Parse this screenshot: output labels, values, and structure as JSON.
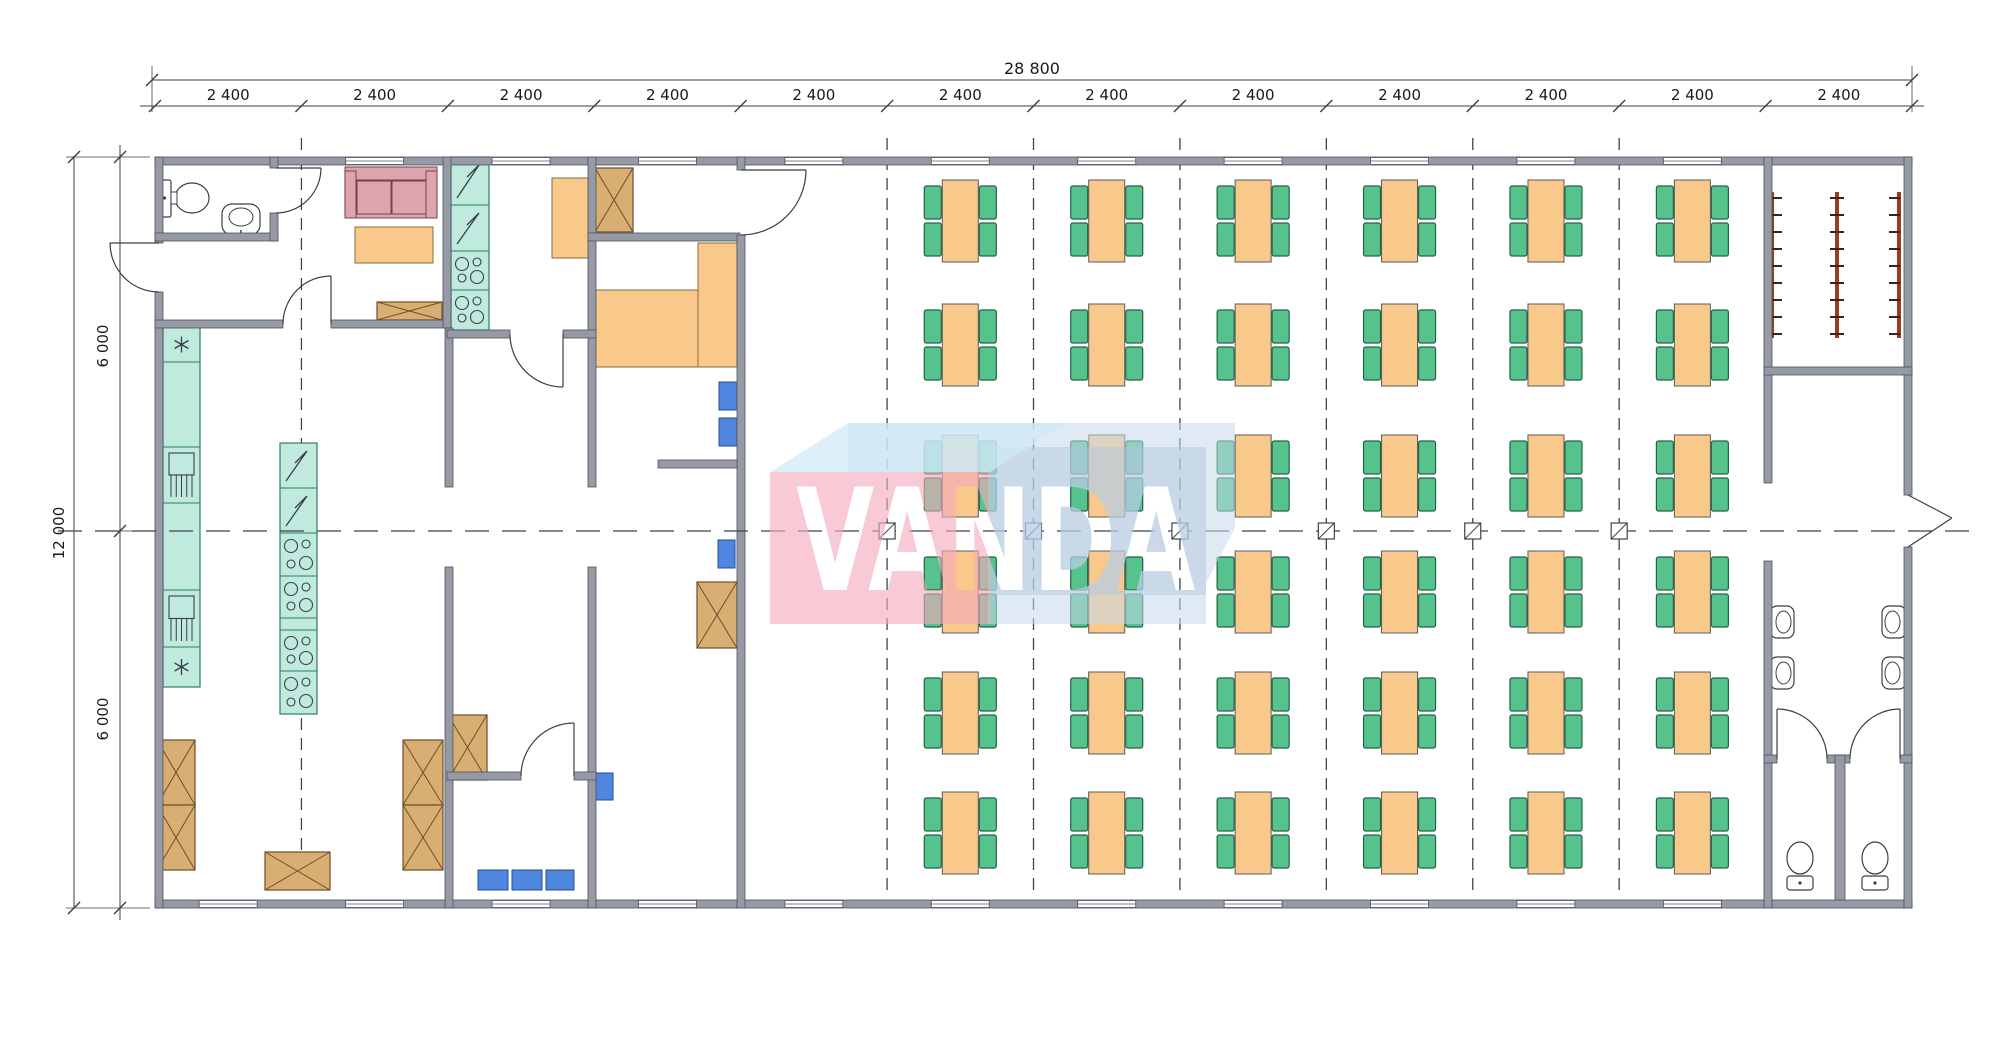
{
  "dimensions": {
    "top": {
      "overall": "28 800",
      "segments": [
        "2 400",
        "2 400",
        "2 400",
        "2 400",
        "2 400",
        "2 400",
        "2 400",
        "2 400",
        "2 400",
        "2 400",
        "2 400",
        "2 400"
      ]
    },
    "left": {
      "overall": "12 000",
      "segments": [
        "6 000",
        "6 000"
      ]
    }
  },
  "watermark": {
    "text": "VANDA"
  },
  "dining_hall": {
    "table_rows": 6,
    "table_columns": 6,
    "seats_per_table": 4
  },
  "cloakroom": {
    "rack_count": 3
  },
  "sanitary": {
    "wash_basins": 4,
    "toilets": 3,
    "toilet_stalls": 2
  },
  "colors": {
    "wall": "#959aa5",
    "wall_edge": "#4e525c",
    "floor": "#ffffff",
    "table": "#f9c98b",
    "table_edge": "#5a5a5a",
    "chair": "#56c38c",
    "chair_edge": "#236247",
    "counter": "#bfeadd",
    "counter_edge": "#2e7d68",
    "storage": "#d9ae73",
    "storage_edge": "#6e4e28",
    "seat_blue": "#4f86e0",
    "seat_blue_edge": "#2a4e91",
    "sofa": "#dba4ae",
    "sofa_edge": "#7a4048",
    "rack": "#a03a1c",
    "grid_line": "#3f444d",
    "fixture_line": "#3a3f47",
    "watermark_pink": "#f2a9bc",
    "watermark_blue": "#c6d9eb",
    "watermark_blue_dark": "#adc6de",
    "watermark_roof": "#cfe9f7"
  }
}
